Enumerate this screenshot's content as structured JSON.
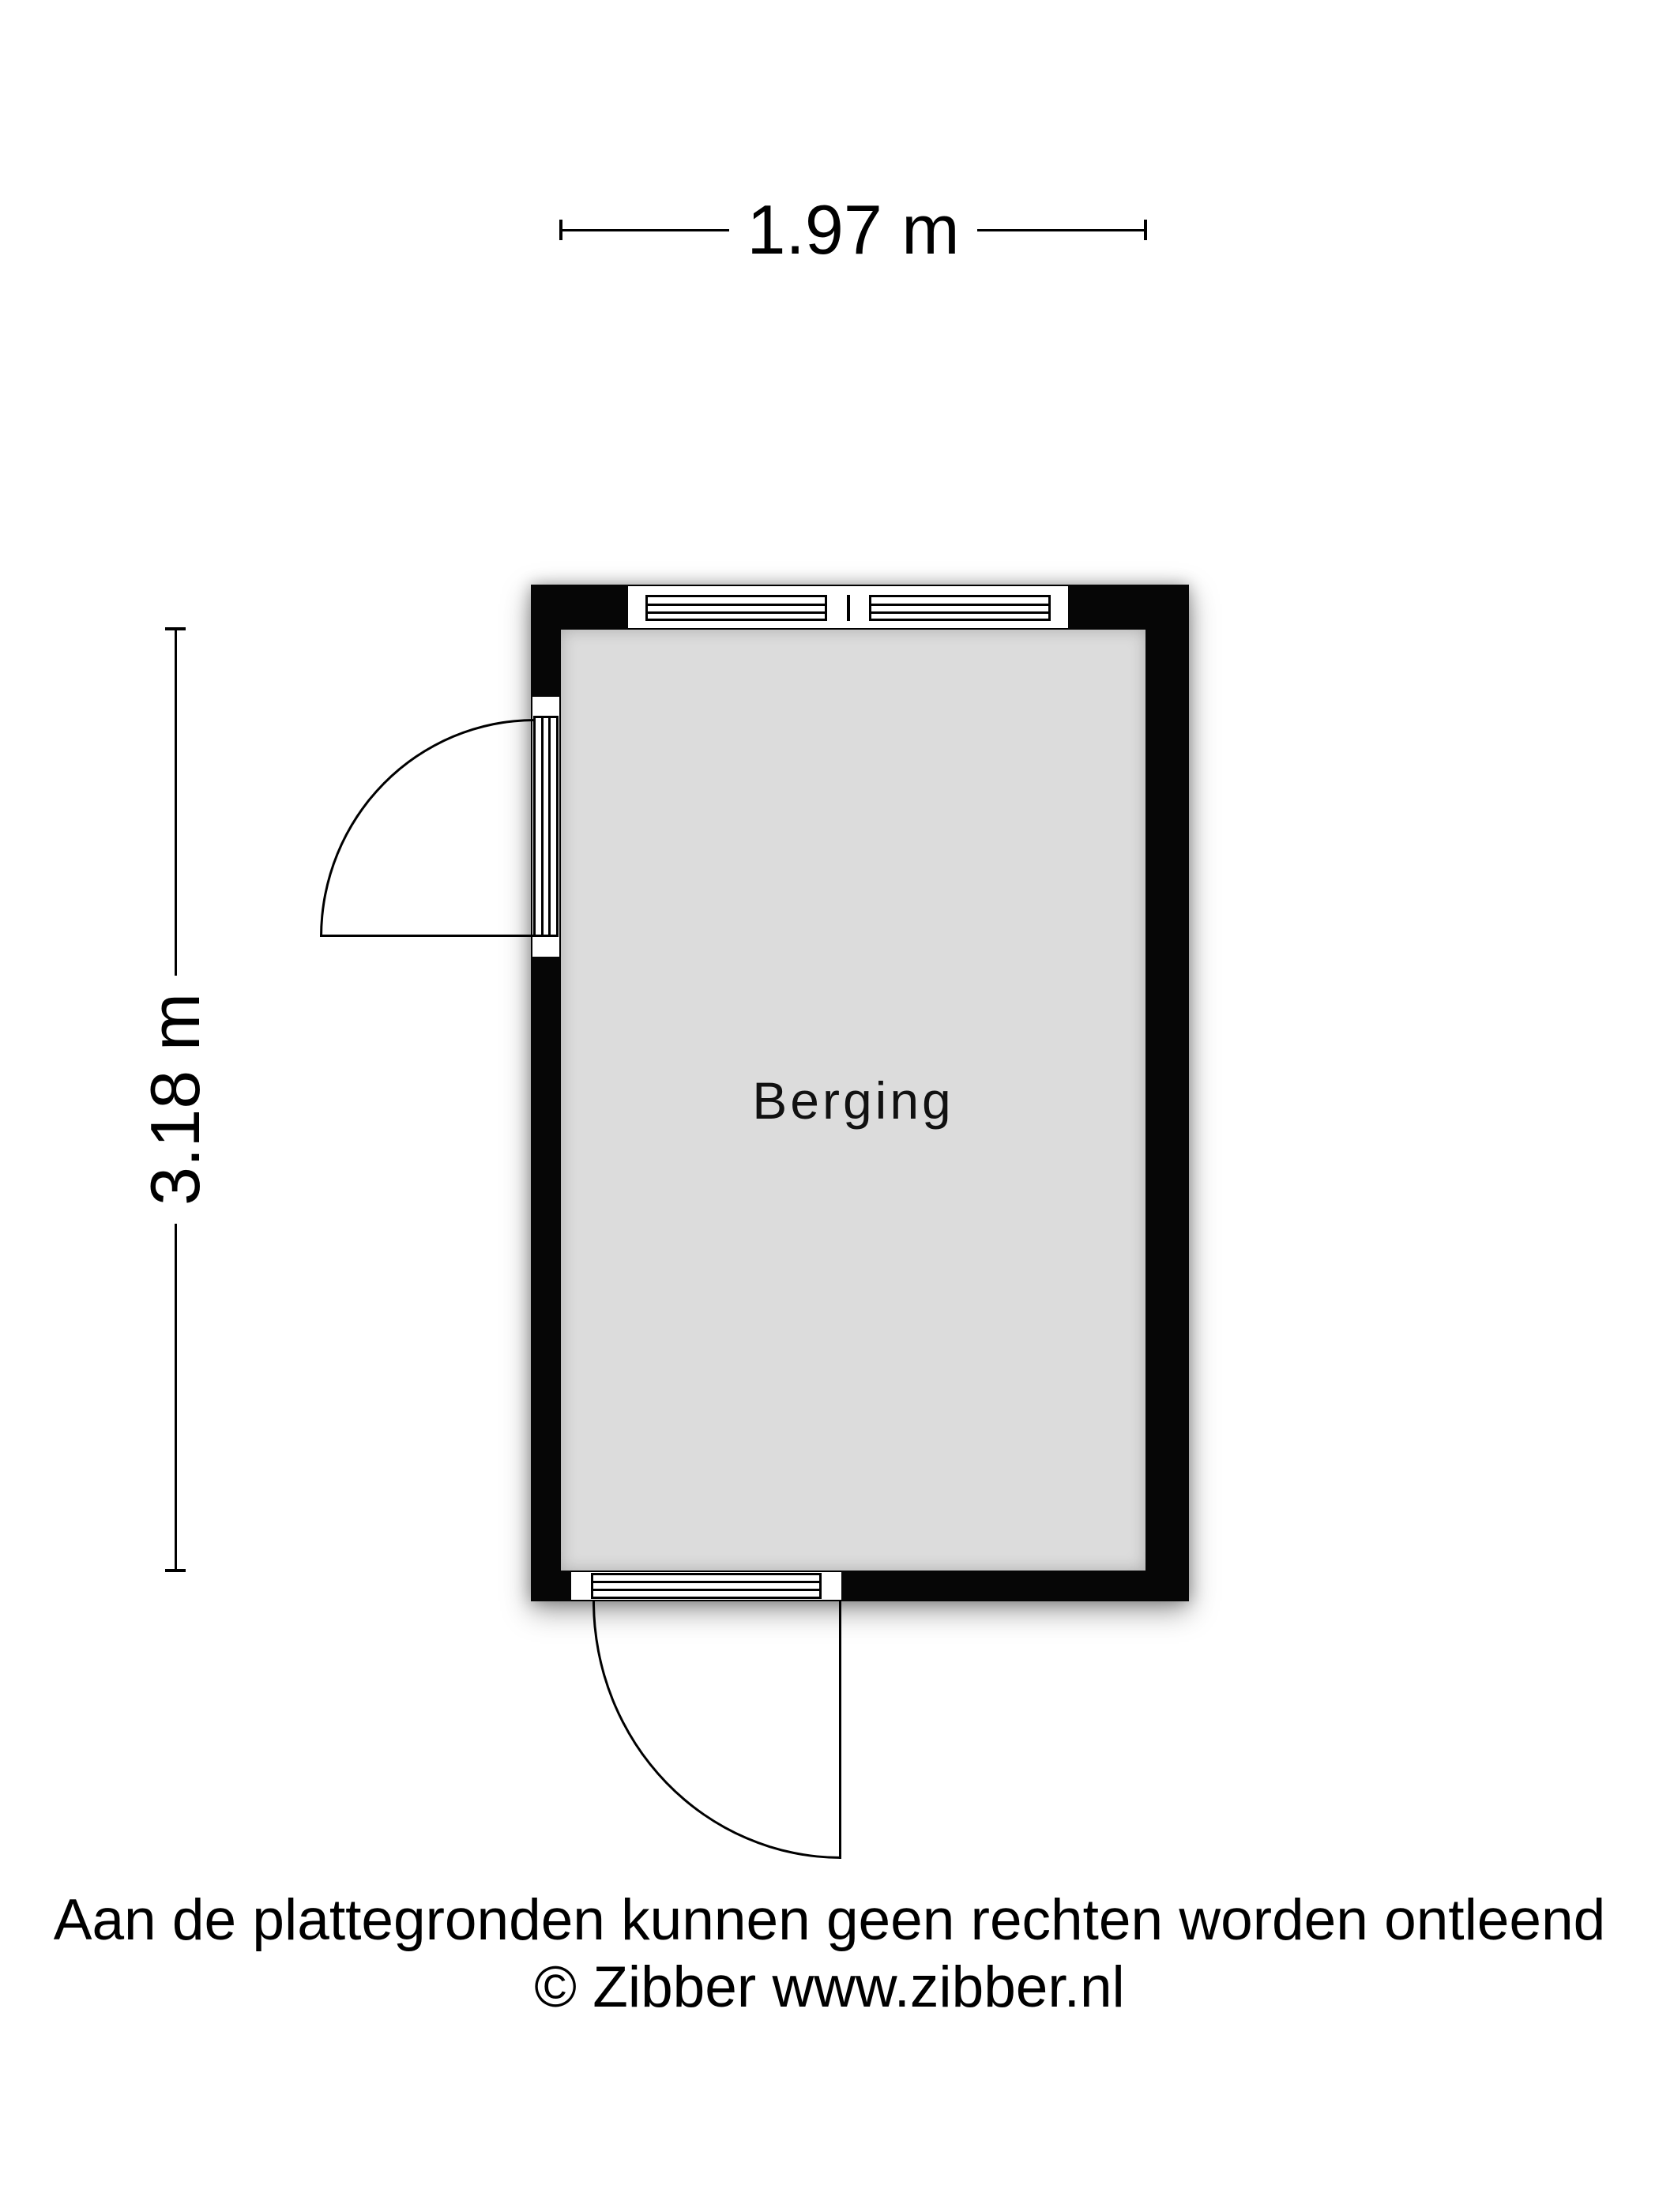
{
  "floorplan": {
    "room": {
      "label": "Berging"
    },
    "dimensions": {
      "width_label": "1.97 m",
      "height_label": "3.18 m"
    },
    "features": {
      "window_top": "double-pane-window",
      "door_left": "outward-swing-door",
      "door_bottom": "outward-swing-door"
    }
  },
  "footer": {
    "disclaimer": "Aan de plattegronden kunnen geen rechten worden ontleend",
    "credit": "© Zibber www.zibber.nl"
  },
  "colors": {
    "wall": "#060606",
    "floor": "#dcdcdc",
    "line": "#000000",
    "page_bg": "#ffffff",
    "text": "#000000"
  }
}
